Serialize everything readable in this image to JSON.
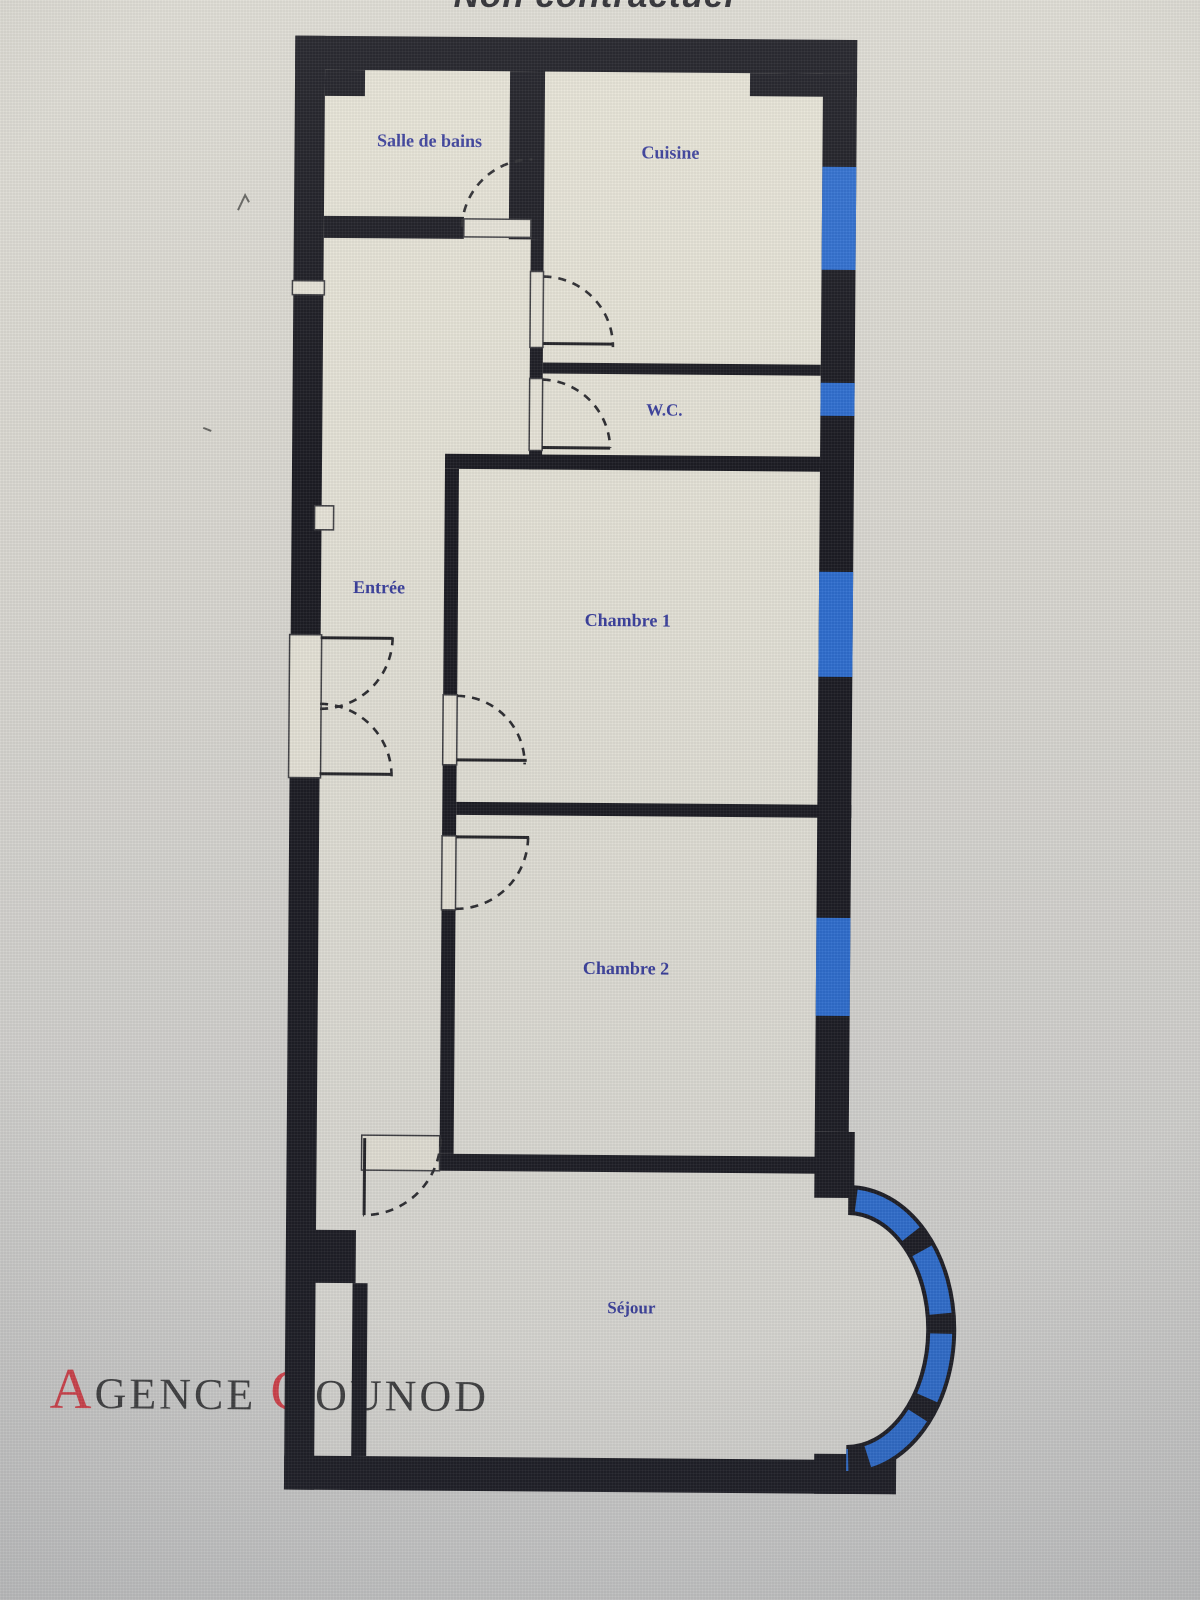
{
  "title": {
    "text": "Non contractuel"
  },
  "watermark": {
    "initial_a": "A",
    "rest_agence": "GENCE ",
    "initial_g": "G",
    "rest_gounod": "OUNOD"
  },
  "rooms": [
    {
      "id": "salle-de-bains",
      "label": "Salle de bains"
    },
    {
      "id": "cuisine",
      "label": "Cuisine"
    },
    {
      "id": "wc",
      "label": "W.C."
    },
    {
      "id": "entree",
      "label": "Entrée"
    },
    {
      "id": "chambre-1",
      "label": "Chambre 1"
    },
    {
      "id": "chambre-2",
      "label": "Chambre 2"
    },
    {
      "id": "sejour",
      "label": "Séjour"
    }
  ],
  "colors": {
    "wall": "#1a1a21",
    "window_glass": "#2d6dcf",
    "room_label": "#383d9b",
    "floor": "#e5e2d6",
    "background": "#d8d7d1",
    "watermark_red": "#d84048",
    "watermark_dark": "#3d3d3d",
    "title_text": "#26262b"
  }
}
